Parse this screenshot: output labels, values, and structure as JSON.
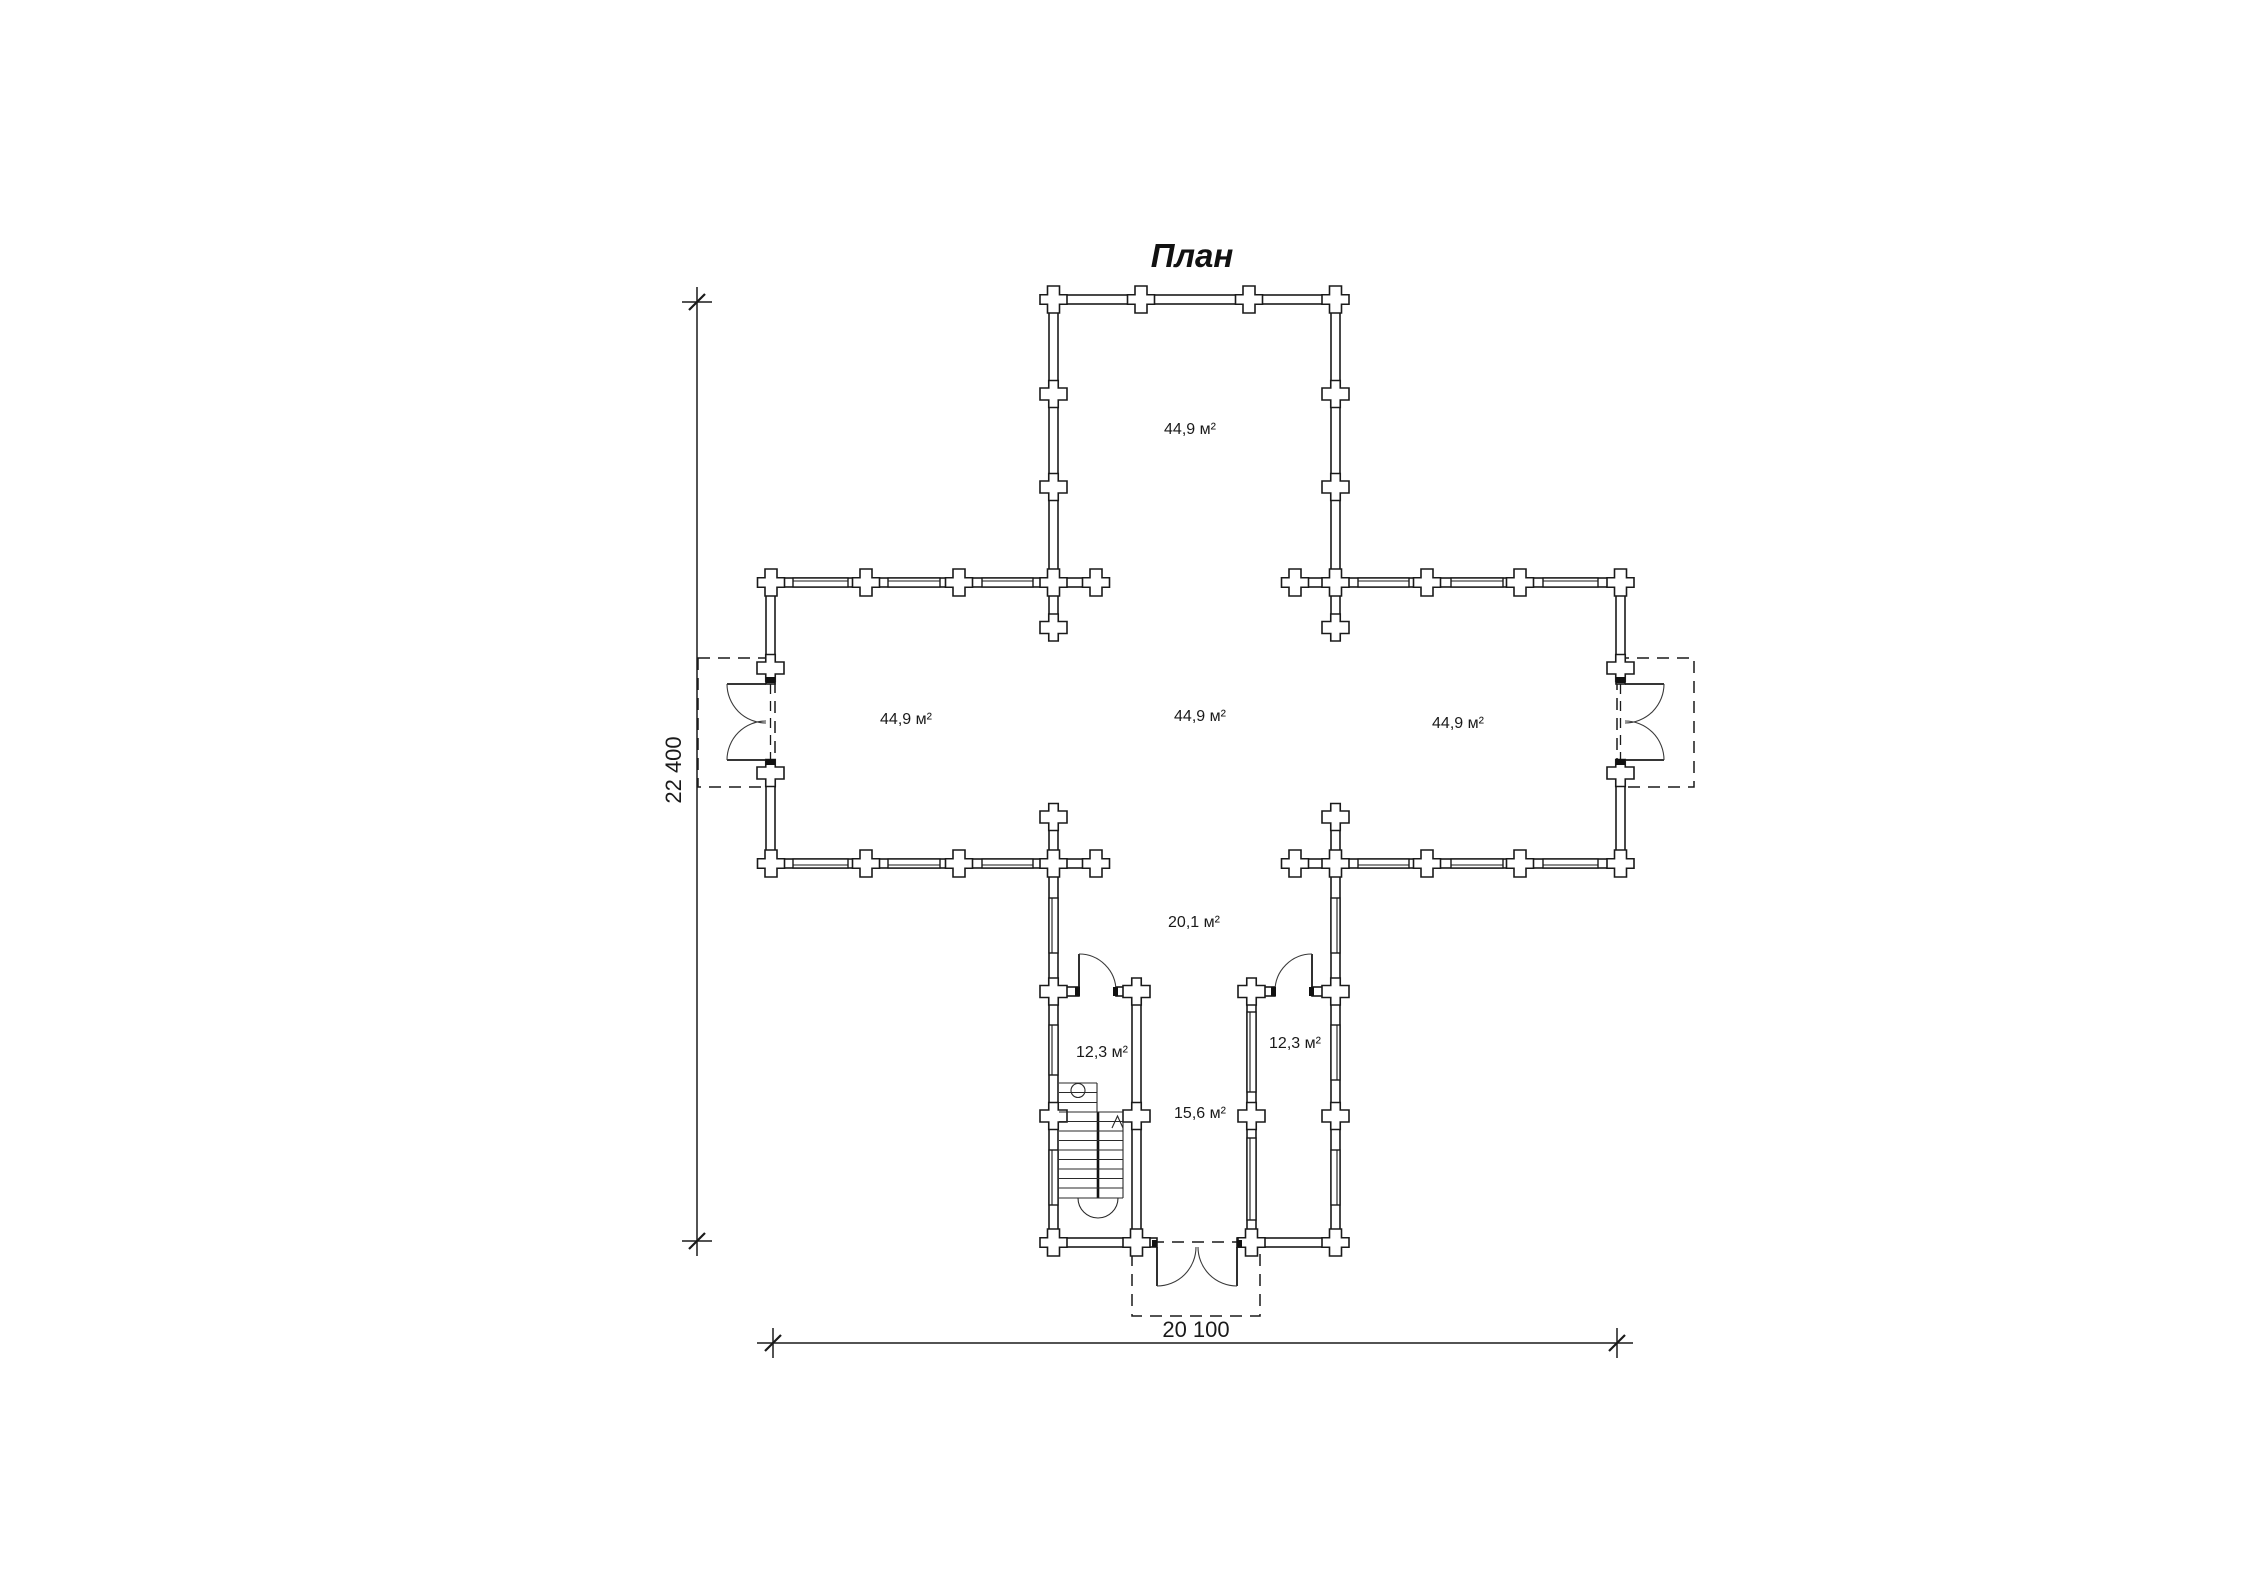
{
  "title": "План",
  "colors": {
    "line": "#1a1a1a",
    "background": "#ffffff"
  },
  "rooms": {
    "north_wing": {
      "label": "44,9 м²"
    },
    "west_wing": {
      "label": "44,9 м²"
    },
    "central_hall": {
      "label": "44,9 м²"
    },
    "east_wing": {
      "label": "44,9 м²"
    },
    "south_hall": {
      "label": "20,1 м²"
    },
    "southwest_room": {
      "label": "12,3 м²"
    },
    "southeast_room": {
      "label": "12,3 м²"
    },
    "vestibule": {
      "label": "15,6 м²"
    }
  },
  "dimensions": {
    "overall_depth": "22 400",
    "overall_width": "20 100"
  }
}
